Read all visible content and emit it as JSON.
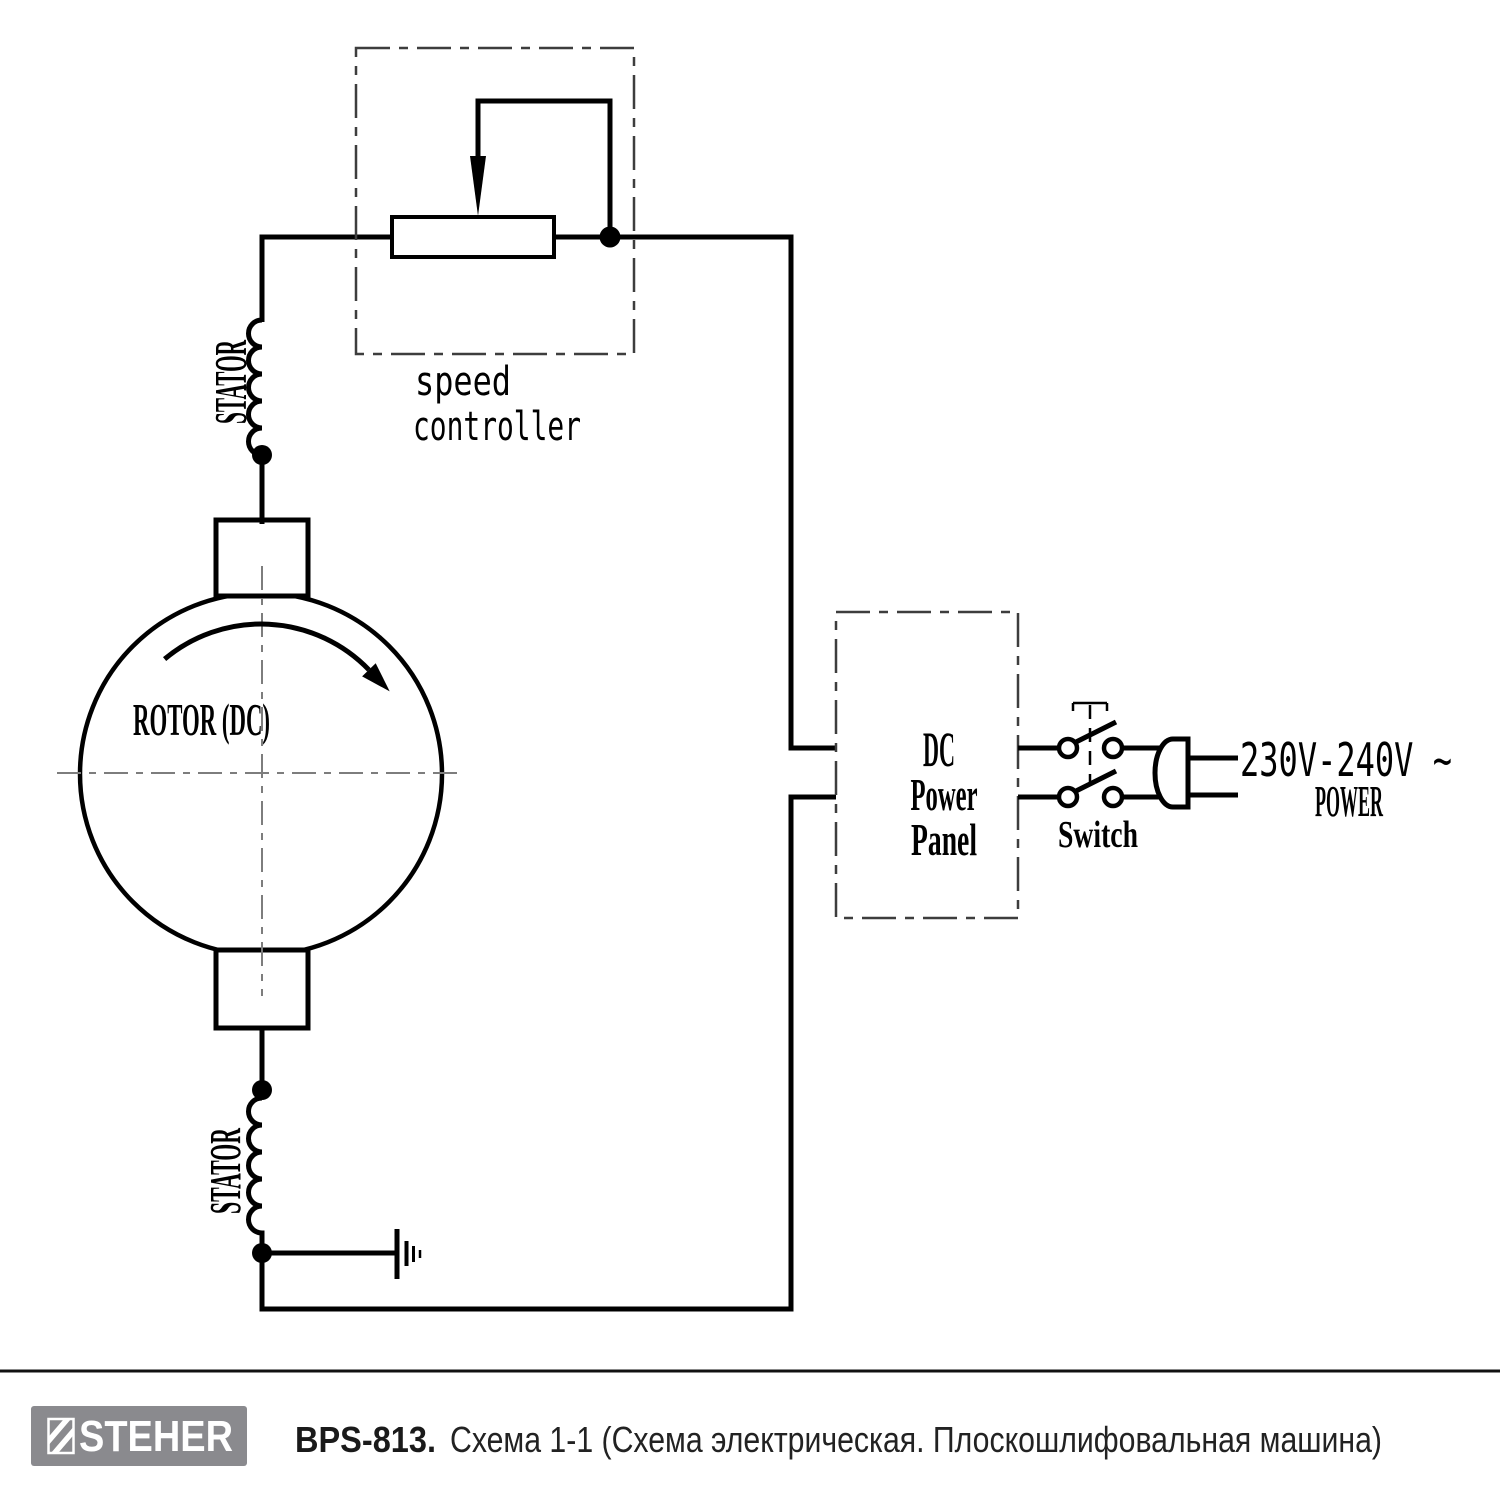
{
  "schematic": {
    "speed_controller": {
      "line1": "speed",
      "line2": "controller"
    },
    "stator_top_label": "STATOR",
    "stator_bottom_label": "STATOR",
    "rotor_label": "ROTOR (DC)",
    "dc_power_panel": {
      "line1": "DC",
      "line2": "Power",
      "line3": "Panel"
    },
    "switch_label": "Switch",
    "voltage_label": "230V-240V ~",
    "power_label": "POWER"
  },
  "footer": {
    "brand": "STEHER",
    "model": "BPS-813.",
    "caption": "Схема 1-1 (Схема электрическая. Плоскошлифовальная машина)"
  },
  "colors": {
    "line": "#000000",
    "dashed_box": "#3d3d3d",
    "centerline": "#7d7d7d",
    "logo_background": "#8a8a8e",
    "footer_text": "#1a1a1a"
  }
}
